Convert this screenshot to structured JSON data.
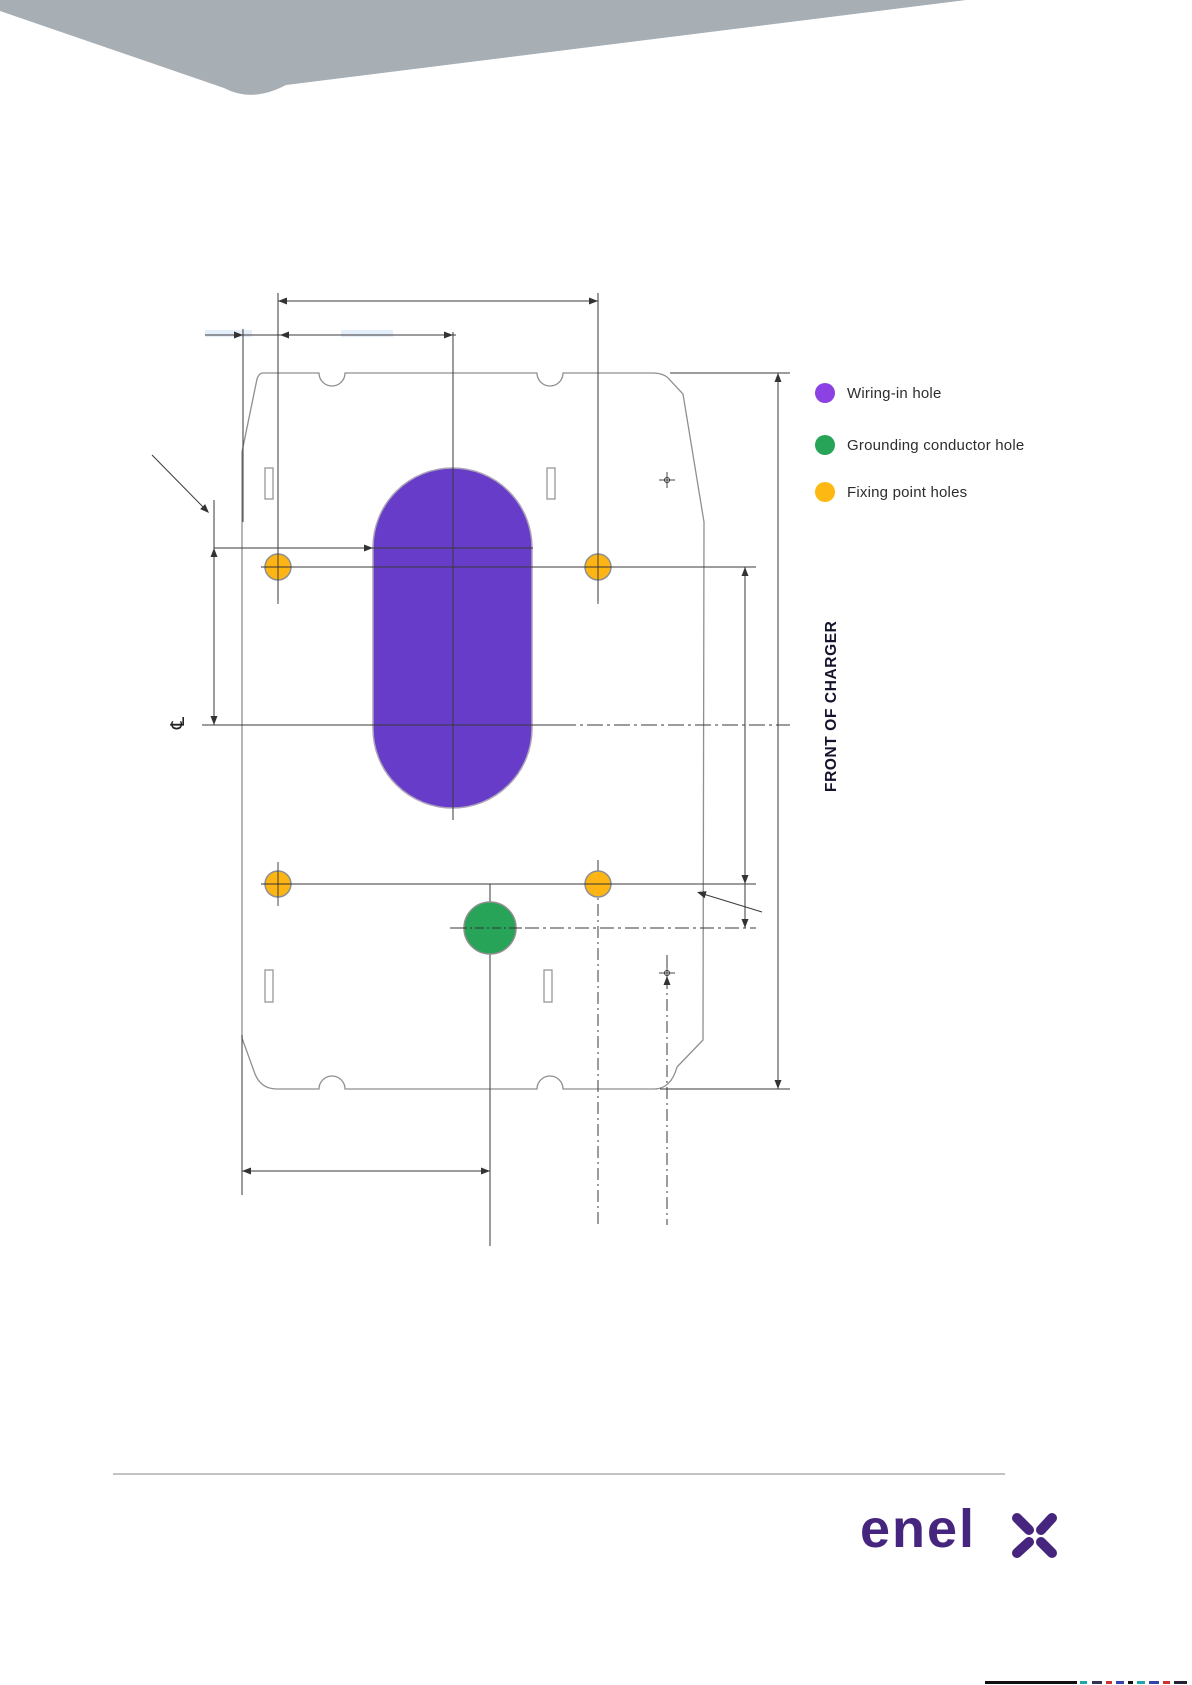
{
  "page": {
    "background_color": "#ffffff",
    "header_band_color": "#a7aeb4"
  },
  "legend": {
    "items": [
      {
        "label": "Wiring-in hole",
        "color": "#8c42e3"
      },
      {
        "label": "Grounding conductor hole",
        "color": "#27a457"
      },
      {
        "label": "Fixing point holes",
        "color": "#fdb813"
      }
    ]
  },
  "side_label": "FRONT OF CHARGER",
  "diagram": {
    "wiring_hole_color": "#673cc8",
    "grounding_hole_color": "#27a457",
    "fixing_hole_color": "#fcb514",
    "outline_color": "#8f8f8f",
    "dimension_line_color": "#3a3a3a",
    "centerline_symbol": "℄"
  },
  "footer": {
    "logo_text": "enel",
    "logo_mark": "x-cross",
    "logo_color": "#46257e",
    "divider_color": "#c2c2c2"
  }
}
